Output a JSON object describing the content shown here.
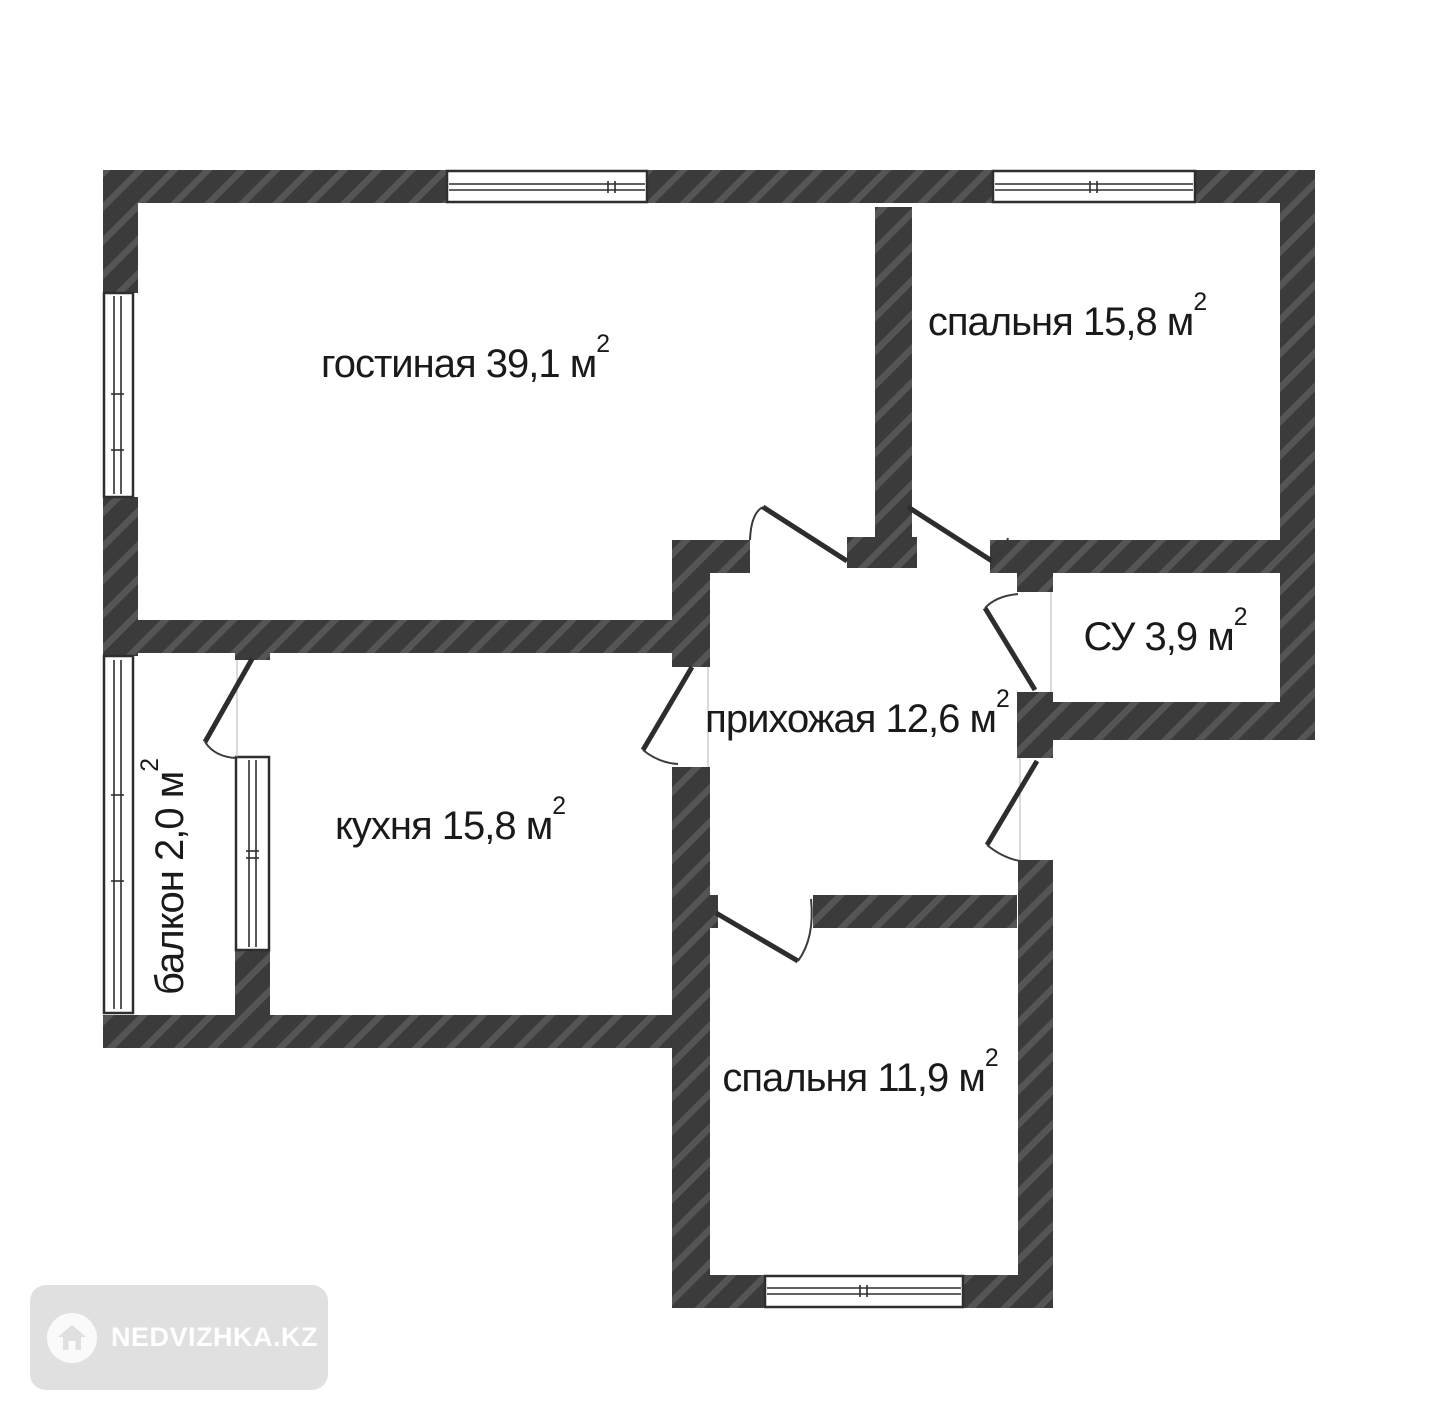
{
  "rooms": {
    "living": {
      "label": "гостиная 39,1 м",
      "sup": "2"
    },
    "bedroom_top": {
      "label": "спальня 15,8 м",
      "sup": "2"
    },
    "bathroom": {
      "label": "СУ 3,9 м",
      "sup": "2"
    },
    "hallway": {
      "label": "прихожая 12,6 м",
      "sup": "2"
    },
    "kitchen": {
      "label": "кухня 15,8 м",
      "sup": "2"
    },
    "balcony": {
      "label": "балкон 2,0 м",
      "sup": "2"
    },
    "bedroom_bottom": {
      "label": "спальня 11,9 м",
      "sup": "2"
    }
  },
  "colors": {
    "wall_base": "#3b3b3b",
    "wall_stripe": "#555555",
    "door_leaf": "#2d2d2d",
    "door_arc": "#3a3a3a",
    "window_frame": "#2e2e2e",
    "text": "#1a1a1a",
    "watermark_bg": "#e0e0e0",
    "watermark_text": "#ffffff"
  },
  "watermark": {
    "text": "NEDVIZHKA.KZ"
  }
}
